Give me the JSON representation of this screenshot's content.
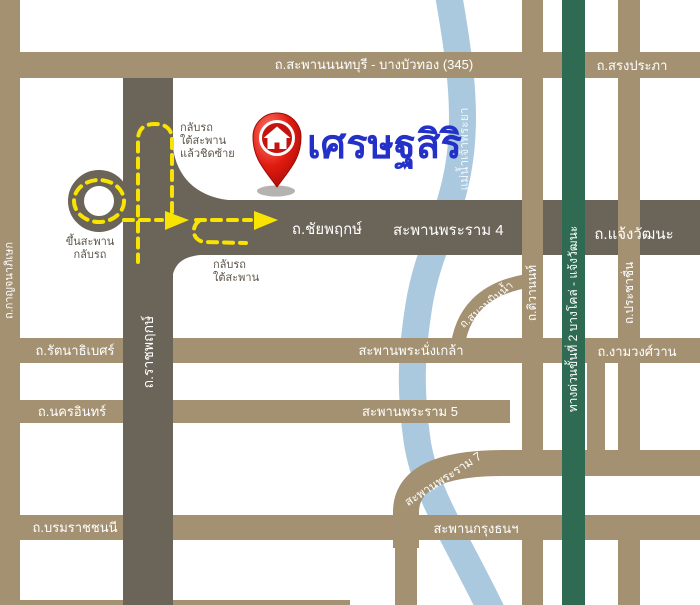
{
  "map": {
    "brand": "เศรษฐสิริ",
    "river_label": "แม่น้ำเจ้าพระยา",
    "roads": {
      "nonthaburi_bridge": "ถ.สะพานนนทบุรี - บางบัวทอง (345)",
      "song_prapha": "ถ.สรงประภา",
      "chaiyaphruek": "ถ.ชัยพฤกษ์",
      "rama4_bridge": "สะพานพระราม 4",
      "chaengwattana": "ถ.แจ้งวัฒนะ",
      "rattanathibet": "ถ.รัตนาธิเบศร์",
      "phranangklao_bridge": "สะพานพระนั่งเกล้า",
      "ngamwongwan": "ถ.งามวงศ์วาน",
      "nakhon_in": "ถ.นครอินทร์",
      "rama5_bridge": "สะพานพระราม 5",
      "rama7_bridge": "สะพานพระราม 7",
      "borommaratchachonnani": "ถ.บรมราชชนนี",
      "krungthon_bridge": "สะพานกรุงธนฯ",
      "kanchanaphisek": "ถ.กาญจนาภิเษก",
      "ratchaphruek": "ถ.ราชพฤกษ์",
      "tiwanon": "ถ.ติวานนท์",
      "sanambinnam": "ถ.สนามบินน้ำ",
      "prachachuen": "ถ.ประชาชื่น",
      "expressway": "ทางด่วนขั้นที่ 2 บางโคล่ - แจ้งวัฒนะ"
    },
    "notes": {
      "uturn_left": "กลับรถ\nใต้สะพาน\nแล้วชิดซ้าย",
      "up_bridge": "ขึ้นสะพาน\nกลับรถ",
      "uturn_under": "กลับรถ\nใต้สะพาน"
    },
    "colors": {
      "road_brown": "#a39172",
      "road_dark": "#6b6459",
      "expressway_green": "#2e6b52",
      "river_blue": "#aac8de",
      "route_yellow": "#f8e400",
      "brand_blue": "#2331c8",
      "pin_red": "#d11a12",
      "note_gray": "#5d5449"
    }
  }
}
